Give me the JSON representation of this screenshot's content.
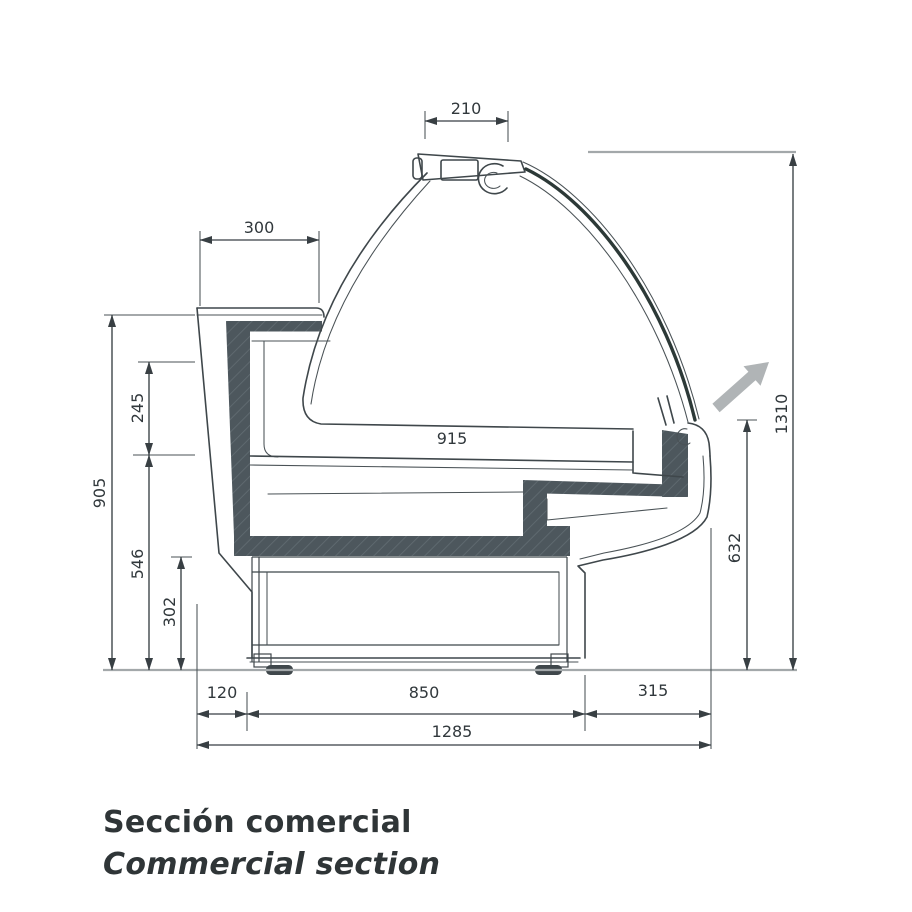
{
  "drawing": {
    "title_es": "Sección comercial",
    "title_en": "Commercial section",
    "type": "refrigerated-display-case-cross-section",
    "units": "mm",
    "dimensions": {
      "canopy_width": "210",
      "ledge_depth": "300",
      "back_height": "905",
      "opening_height": "245",
      "well_height": "546",
      "base_height": "302",
      "deck_length": "915",
      "total_height": "1310",
      "front_height": "632",
      "back_overhang": "120",
      "base_width": "850",
      "front_overhang": "315",
      "total_width": "1285"
    },
    "colors": {
      "line": "#3f474b",
      "insulation_fill": "#4d575d",
      "dimension_text": "#31383c",
      "reference_gray": "#a3a8aa",
      "airflow_arrow": "#b0b4b6",
      "background": "#ffffff"
    },
    "icons": {
      "airflow": "airflow-arrow"
    }
  }
}
